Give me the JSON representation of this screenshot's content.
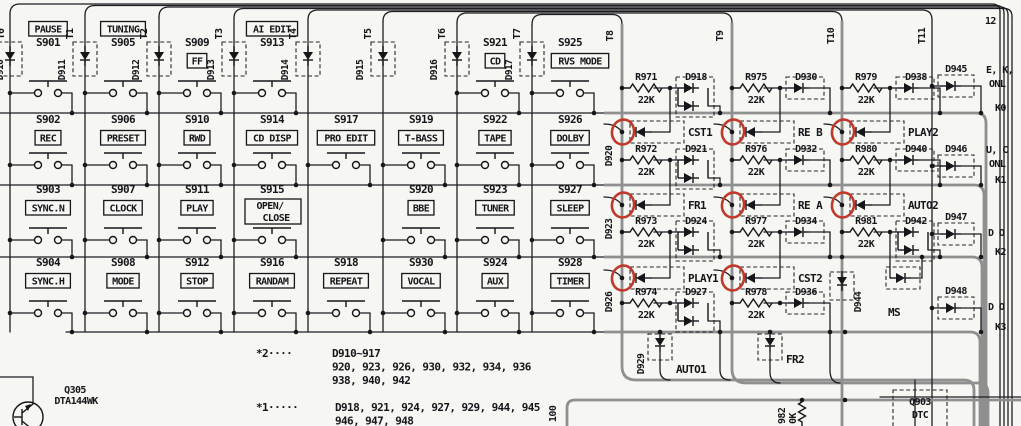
{
  "schematic": {
    "annotation_color": "#c0392b",
    "key_columns": [
      {
        "t": "T0",
        "d": "D910",
        "switches": [
          {
            "s": "S901",
            "cap": "PAUSE",
            "pos": "above"
          },
          {
            "s": "S902",
            "cap": "REC"
          },
          {
            "s": "S903",
            "cap": "SYNC.N"
          },
          {
            "s": "S904",
            "cap": "SYNC.H"
          }
        ]
      },
      {
        "t": "T1",
        "d": "D911",
        "switches": [
          {
            "s": "S905",
            "cap": "TUNING",
            "pos": "above"
          },
          {
            "s": "S906",
            "cap": "PRESET"
          },
          {
            "s": "S907",
            "cap": "CLOCK"
          },
          {
            "s": "S908",
            "cap": "MODE"
          }
        ]
      },
      {
        "t": "T2",
        "d": "D912",
        "switches": [
          {
            "s": "S909",
            "cap": "FF",
            "pos": "below"
          },
          {
            "s": "S910",
            "cap": "RWD"
          },
          {
            "s": "S911",
            "cap": "PLAY"
          },
          {
            "s": "S912",
            "cap": "STOP"
          }
        ]
      },
      {
        "t": "T3",
        "d": "D913",
        "switches": [
          {
            "s": "S913",
            "cap": "AI EDIT",
            "pos": "above"
          },
          {
            "s": "S914",
            "cap": "CD DISP"
          },
          {
            "s": "S915",
            "cap": "OPEN/",
            "cap2": "CLOSE"
          },
          {
            "s": "S916",
            "cap": "RANDAM"
          }
        ]
      },
      {
        "t": "T4",
        "d": "D914",
        "switches": [
          null,
          {
            "s": "S917",
            "cap": "PRO EDIT"
          },
          null,
          {
            "s": "S918",
            "cap": "REPEAT"
          }
        ]
      },
      {
        "t": "T5",
        "d": "D915",
        "switches": [
          null,
          {
            "s": "S919",
            "cap": "T-BASS"
          },
          {
            "s": "S920",
            "cap": "BBE"
          },
          {
            "s": "S930",
            "cap": "VOCAL"
          }
        ]
      },
      {
        "t": "T6",
        "d": "D916",
        "switches": [
          {
            "s": "S921",
            "cap": "CD",
            "pos": "below"
          },
          {
            "s": "S922",
            "cap": "TAPE"
          },
          {
            "s": "S923",
            "cap": "TUNER"
          },
          {
            "s": "S924",
            "cap": "AUX"
          }
        ]
      },
      {
        "t": "T7",
        "d": "D917",
        "switches": [
          {
            "s": "S925",
            "cap": "RVS MODE",
            "pos": "below"
          },
          {
            "s": "S926",
            "cap": "DOLBY"
          },
          {
            "s": "S927",
            "cap": "SLEEP"
          },
          {
            "s": "S928",
            "cap": "TIMER"
          }
        ]
      }
    ],
    "matrix_columns": [
      {
        "t": "T8",
        "cells": [
          {
            "r": "R971",
            "rv": "22K",
            "d": "D918",
            "dd": true,
            "fd": "D920",
            "sig": "CST1",
            "ann": true
          },
          {
            "r": "R972",
            "rv": "22K",
            "d": "D921",
            "dd": true,
            "fd": "D923",
            "sig": "FR1",
            "ann": true
          },
          {
            "r": "R973",
            "rv": "22K",
            "d": "D924",
            "dd": true,
            "fd": "D926",
            "sig": "PLAY1",
            "ann": true
          },
          {
            "r": "R974",
            "rv": "22K",
            "d": "D927",
            "dd": true,
            "fd": "D929",
            "sig": "AUTO1",
            "down": true
          }
        ]
      },
      {
        "t": "T9",
        "cells": [
          {
            "r": "R975",
            "rv": "22K",
            "d": "D930",
            "sig": "RE B",
            "ann": true
          },
          {
            "r": "R976",
            "rv": "22K",
            "d": "D932",
            "sig": "RE A",
            "ann": true
          },
          {
            "r": "R977",
            "rv": "22K",
            "d": "D934",
            "sig": "CST2",
            "ann": true
          },
          {
            "r": "R978",
            "rv": "22K",
            "d": "D936",
            "sig": "FR2",
            "down": true
          }
        ]
      },
      {
        "t": "T10",
        "cells": [
          {
            "r": "R979",
            "rv": "22K",
            "d": "D938",
            "sig": "PLAY2",
            "ann": true
          },
          {
            "r": "R980",
            "rv": "22K",
            "d": "D940",
            "sig": "AUTO2",
            "ann": true
          },
          {
            "r": "R981",
            "rv": "22K",
            "d": "D942",
            "dd": true,
            "sig": "MS",
            "extra": "D944"
          }
        ]
      },
      {
        "t": "T11",
        "cells": []
      }
    ],
    "k_rows": [
      {
        "k": "K0",
        "d": "D945",
        "l1": "E, K,",
        "l2": "ONL"
      },
      {
        "k": "K1",
        "d": "D946",
        "l1": "U, C",
        "l2": "ONL"
      },
      {
        "k": "K2",
        "d": "D947",
        "l1": "D O",
        "l2": ""
      },
      {
        "k": "K3",
        "d": "D948",
        "l1": "D O",
        "l2": ""
      }
    ],
    "notes": {
      "n2_star": "*2····",
      "n2_lines": [
        "D910~917",
        "920, 923, 926, 930, 932, 934, 936",
        "938, 940, 942"
      ],
      "n1_star": "*1·····",
      "n1_lines": [
        "D918, 921, 924, 927, 929, 944, 945",
        "946, 947, 948"
      ]
    },
    "q305": {
      "ref": "Q305",
      "part": "DTA144WK"
    },
    "q903": {
      "ref": "Q903",
      "part": "DTC"
    },
    "misc": {
      "pin12": "12",
      "v100": "100",
      "r982": "982",
      "r982v": "0K"
    }
  }
}
